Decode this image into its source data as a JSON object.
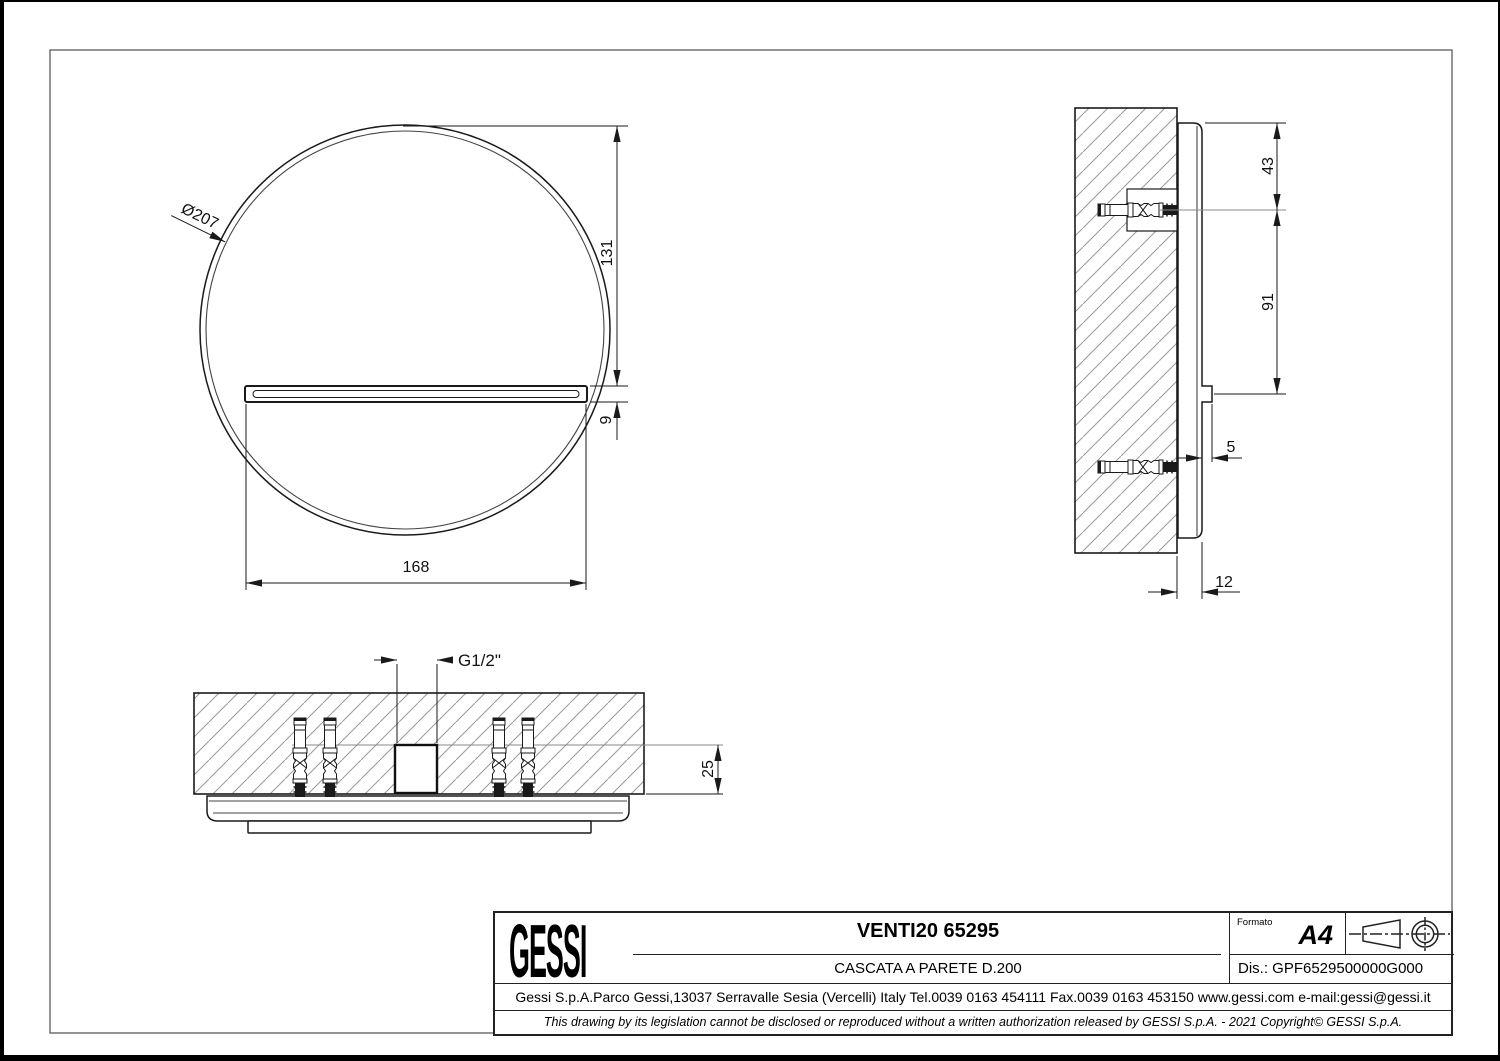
{
  "document": {
    "type": "technical drawing",
    "paper_format_note": "A4 drawing sheet with border frame"
  },
  "colors": {
    "line": "#1a1a1a",
    "hatch": "#9a9a9a",
    "background": "#ffffff"
  },
  "views": {
    "front": {
      "dims": {
        "diameter": "Ø207",
        "top_to_spout": "131",
        "spout_height": "9",
        "spout_width": "168"
      }
    },
    "side": {
      "dims": {
        "plate_top_to_anchor": "43",
        "anchor_to_spout": "91",
        "spout_projection": "5",
        "plate_thickness": "12"
      }
    },
    "bottom": {
      "dims": {
        "inlet_thread": "G1/2\"",
        "recess_depth": "25"
      }
    }
  },
  "title_block": {
    "brand": "GESSI",
    "title": "VENTI20 65295",
    "subtitle": "CASCATA A PARETE D.200",
    "format_label": "Formato",
    "format_value": "A4",
    "drawing_code": "Dis.: GPF6529500000G000",
    "address": "Gessi S.p.A.Parco Gessi,13037 Serravalle Sesia (Vercelli) Italy Tel.0039 0163 454111 Fax.0039 0163 453150 www.gessi.com e-mail:gessi@gessi.it",
    "disclaimer": "This drawing by its legislation cannot be disclosed or reproduced without a written authorization released by GESSI S.p.A. - 2021 Copyright© GESSI S.p.A."
  }
}
